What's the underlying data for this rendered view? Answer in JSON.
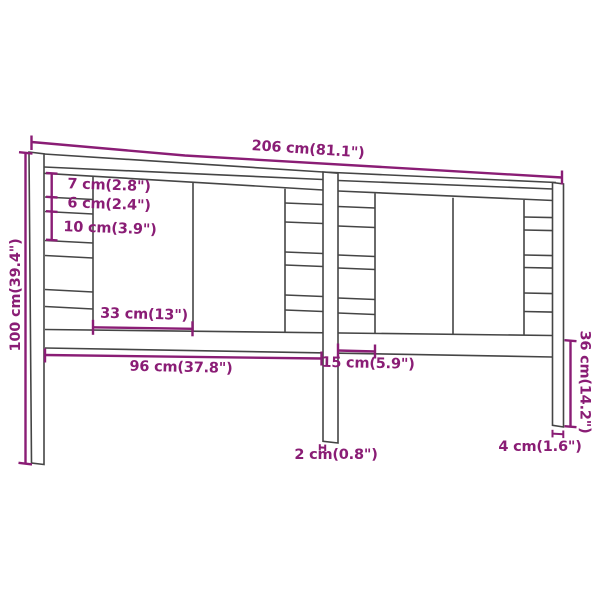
{
  "diagram": {
    "title": "Headboard dimension diagram",
    "background_color": "#ffffff",
    "line_color": "#454545",
    "dimension_color": "#8a1d75",
    "labels": {
      "total_width": "206 cm(81.1\")",
      "total_height": "100 cm(39.4\")",
      "slat_7": "7 cm(2.8\")",
      "gap_6": "6 cm(2.4\")",
      "slat_10": "10 cm(3.9\")",
      "panel_33": "33 cm(13\")",
      "span_96": "96 cm(37.8\")",
      "slat_len_15": "15 cm(5.9\")",
      "leg_36": "36 cm(14.2\")",
      "leg_4": "4 cm(1.6\")",
      "thickness_2": "2 cm(0.8\")"
    }
  }
}
